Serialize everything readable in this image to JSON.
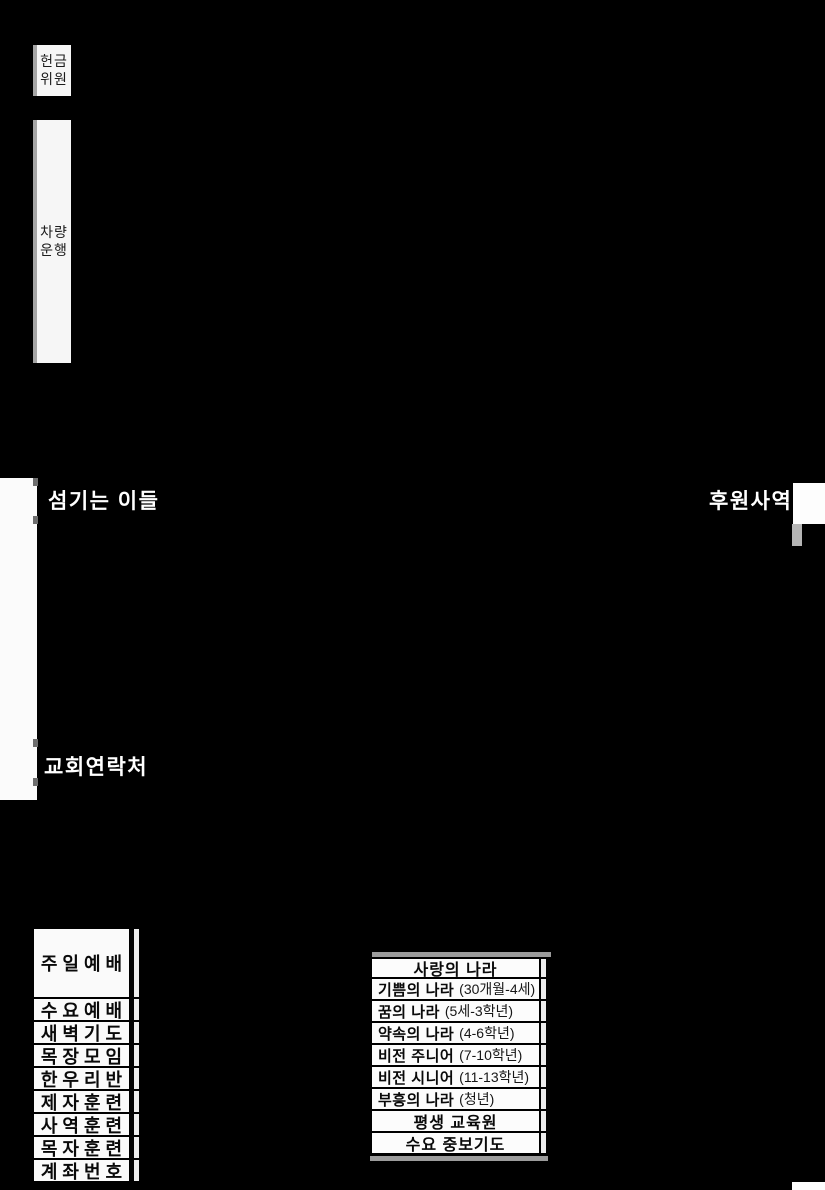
{
  "colors": {
    "background": "#000000",
    "panel_bg": "#fafafa",
    "border": "#000000",
    "gray_strip": "#9b9b9b",
    "title_text": "#ffffff",
    "body_text": "#0a0a0a"
  },
  "margin_labels": {
    "offering": {
      "line1": "헌금",
      "line2": "위원"
    },
    "vehicle": {
      "line1": "차량",
      "line2": "운행"
    }
  },
  "section_titles": {
    "serving": "섬기는 이들",
    "support": "후원사역",
    "contact": "교회연락처"
  },
  "schedule": {
    "rows": [
      "주일예배",
      "수요예배",
      "새벽기도",
      "목장모임",
      "한우리반",
      "제자훈련",
      "사역훈련",
      "목자훈련",
      "계좌번호"
    ]
  },
  "ministries": {
    "header": "사랑의 나라",
    "rows": [
      {
        "name": "기쁨의 나라",
        "detail": "(30개월-4세)"
      },
      {
        "name": "꿈의 나라",
        "detail": "(5세-3학년)"
      },
      {
        "name": "약속의 나라",
        "detail": "(4-6학년)"
      },
      {
        "name": "비전 주니어",
        "detail": "(7-10학년)"
      },
      {
        "name": "비전 시니어",
        "detail": "(11-13학년)"
      },
      {
        "name": "부흥의 나라",
        "detail": "(청년)"
      }
    ],
    "footers": [
      "평생 교육원",
      "수요 중보기도"
    ]
  }
}
